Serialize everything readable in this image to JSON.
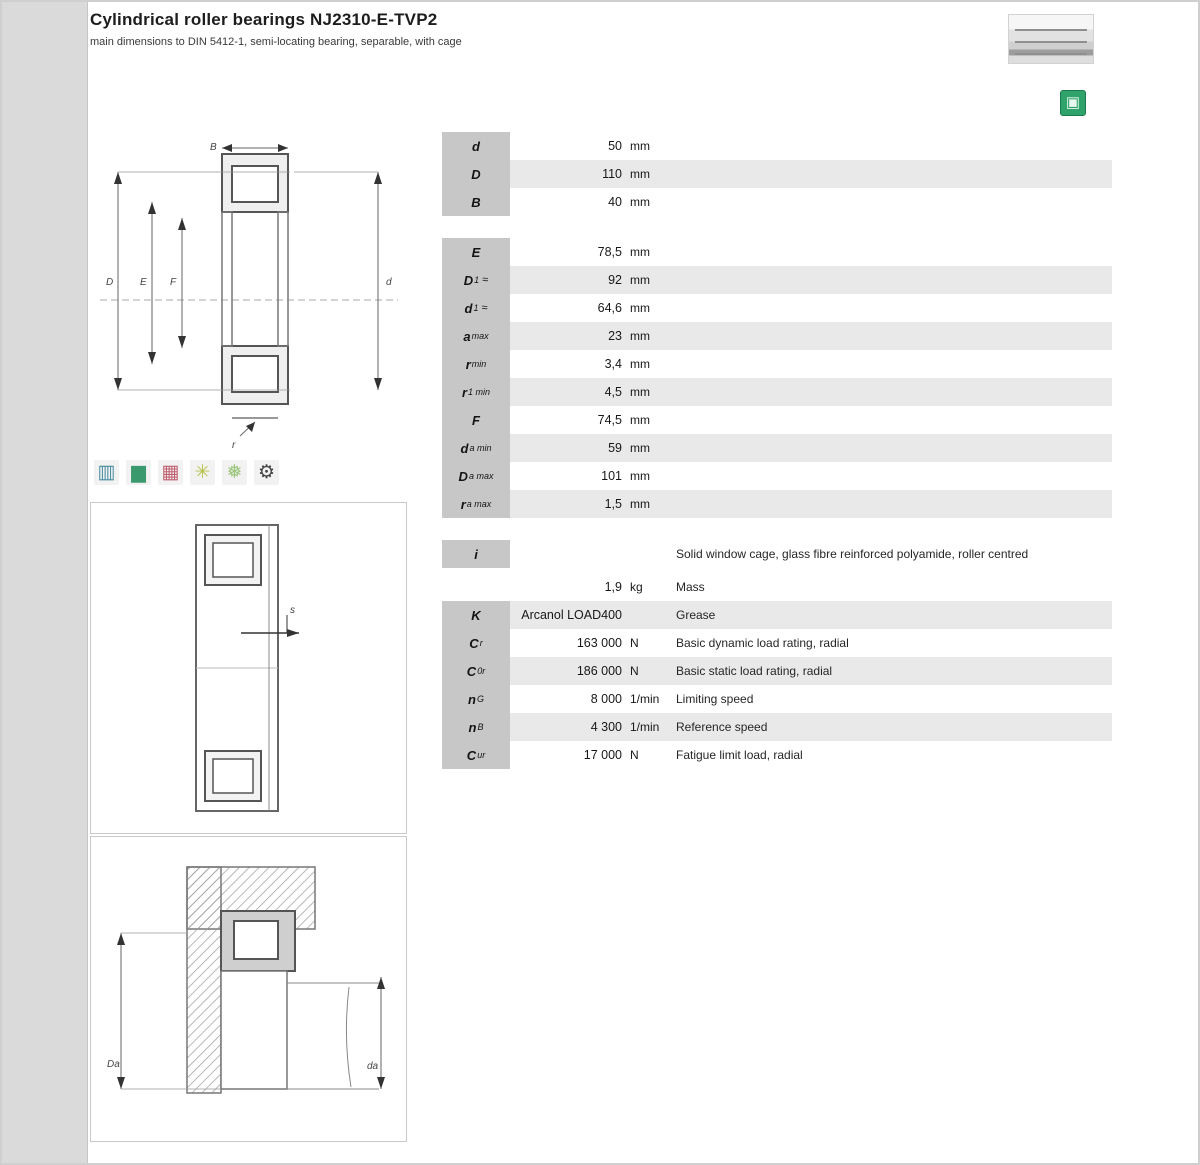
{
  "header": {
    "title": "Cylindrical roller bearings NJ2310-E-TVP2",
    "subtitle": "main dimensions to DIN 5412-1, semi-locating bearing, separable, with cage"
  },
  "brand": {
    "logo_name": "schaeffler-logo",
    "accent_green": "#2fa36b"
  },
  "catalog_button": {
    "glyph": "▣"
  },
  "feature_icons": [
    {
      "name": "load-direction-icon",
      "glyph": "▥",
      "color": "#4a8fa0"
    },
    {
      "name": "speed-icon",
      "glyph": "▆",
      "color": "#3a9a6e"
    },
    {
      "name": "load-grid-icon",
      "glyph": "▦",
      "color": "#c06070"
    },
    {
      "name": "temperature-icon",
      "glyph": "✳",
      "color": "#b8c24a"
    },
    {
      "name": "lubrication-icon",
      "glyph": "❅",
      "color": "#9ac47a"
    },
    {
      "name": "mounting-icon",
      "glyph": "⚙",
      "color": "#444444"
    }
  ],
  "drawings": {
    "main": {
      "top": "B",
      "left_outer": "D",
      "left_mid": "E",
      "left_inner": "F",
      "right": "d",
      "bottom": "r"
    },
    "displacement": {
      "arrow": "s"
    },
    "mounting": {
      "left": "Da",
      "right": "da"
    }
  },
  "table": {
    "sections": [
      {
        "name": "main-dimensions",
        "rows": [
          {
            "l": "d",
            "s": "",
            "x": "",
            "v": "50",
            "u": "mm",
            "d": ""
          },
          {
            "l": "D",
            "s": "",
            "x": "",
            "v": "110",
            "u": "mm",
            "d": ""
          },
          {
            "l": "B",
            "s": "",
            "x": "",
            "v": "40",
            "u": "mm",
            "d": ""
          }
        ]
      },
      {
        "name": "dimensions",
        "rows": [
          {
            "l": "E",
            "s": "",
            "x": "",
            "v": "78,5",
            "u": "mm",
            "d": ""
          },
          {
            "l": "D",
            "s": "1",
            "x": "≈",
            "v": "92",
            "u": "mm",
            "d": ""
          },
          {
            "l": "d",
            "s": "1",
            "x": "≈",
            "v": "64,6",
            "u": "mm",
            "d": ""
          },
          {
            "l": "a",
            "s": "max",
            "x": "",
            "v": "23",
            "u": "mm",
            "d": ""
          },
          {
            "l": "r",
            "s": "min",
            "x": "",
            "v": "3,4",
            "u": "mm",
            "d": ""
          },
          {
            "l": "r",
            "s": "1 min",
            "x": "",
            "v": "4,5",
            "u": "mm",
            "d": ""
          },
          {
            "l": "F",
            "s": "",
            "x": "",
            "v": "74,5",
            "u": "mm",
            "d": ""
          },
          {
            "l": "d",
            "s": "a min",
            "x": "",
            "v": "59",
            "u": "mm",
            "d": ""
          },
          {
            "l": "D",
            "s": "a max",
            "x": "",
            "v": "101",
            "u": "mm",
            "d": ""
          },
          {
            "l": "r",
            "s": "a max",
            "x": "",
            "v": "1,5",
            "u": "mm",
            "d": ""
          }
        ]
      },
      {
        "name": "cage-note",
        "tight": true,
        "rows": [
          {
            "l": "i",
            "s": "",
            "x": "",
            "v": "",
            "u": "",
            "d": "Solid window cage, glass fibre reinforced polyamide, roller centred"
          }
        ]
      },
      {
        "name": "performance",
        "rows": [
          {
            "l": "m",
            "s": "",
            "x": "",
            "v": "1,9",
            "u": "kg",
            "d": "Mass",
            "nobox": true
          },
          {
            "l": "K",
            "s": "",
            "x": "",
            "v": "Arcanol LOAD400",
            "u": "",
            "d": "Grease"
          },
          {
            "l": "C",
            "s": "r",
            "x": "",
            "v": "163 000",
            "u": "N",
            "d": "Basic dynamic load rating, radial"
          },
          {
            "l": "C",
            "s": "0r",
            "x": "",
            "v": "186 000",
            "u": "N",
            "d": "Basic static load rating, radial"
          },
          {
            "l": "n",
            "s": "G",
            "x": "",
            "v": "8 000",
            "u": "1/min",
            "d": "Limiting speed"
          },
          {
            "l": "n",
            "s": "B",
            "x": "",
            "v": "4 300",
            "u": "1/min",
            "d": "Reference speed"
          },
          {
            "l": "C",
            "s": "ur",
            "x": "",
            "v": "17 000",
            "u": "N",
            "d": "Fatigue limit load, radial"
          }
        ]
      }
    ]
  }
}
